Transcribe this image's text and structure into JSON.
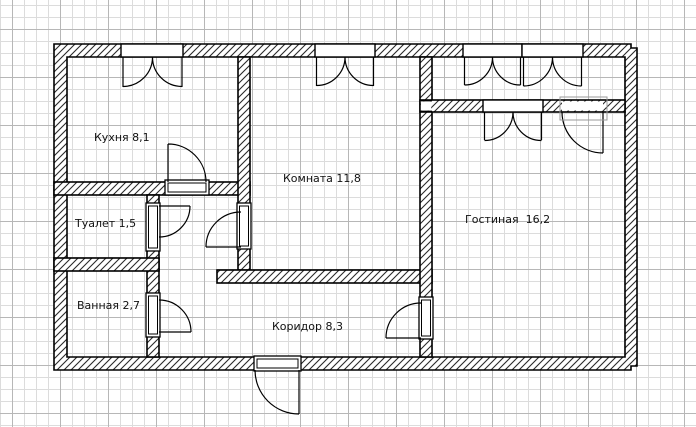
{
  "plan": {
    "type": "apartment-floor-plan",
    "rooms": [
      {
        "name": "Кухня",
        "area": "8,1",
        "label": "Кухня 8,1"
      },
      {
        "name": "Туалет",
        "area": "1,5",
        "label": "Туалет 1,5"
      },
      {
        "name": "Ванная",
        "area": "2,7",
        "label": "Ванная 2,7"
      },
      {
        "name": "Комната",
        "area": "11,8",
        "label": "Комната 11,8"
      },
      {
        "name": "Гостиная",
        "area": "16,2",
        "label": "Гостиная  16,2"
      },
      {
        "name": "Коридор",
        "area": "8,3",
        "label": "Коридор 8,3"
      }
    ],
    "openings": {
      "windows": [
        "kitchen-window",
        "room-window",
        "balcony-window-left",
        "balcony-window-right",
        "balcony-inner-window"
      ],
      "doors": [
        "kitchen-door",
        "toilet-door",
        "bathroom-door",
        "room-door",
        "living-room-door",
        "balcony-door",
        "entry-door"
      ]
    },
    "colors": {
      "wall_line": "#000000",
      "hatch_line": "#2a2a2a",
      "grid_minor": "#dcdcdc",
      "grid_major": "#b7b7b7",
      "paper": "#ffffff",
      "selection_box": "#9a9a9a"
    }
  }
}
